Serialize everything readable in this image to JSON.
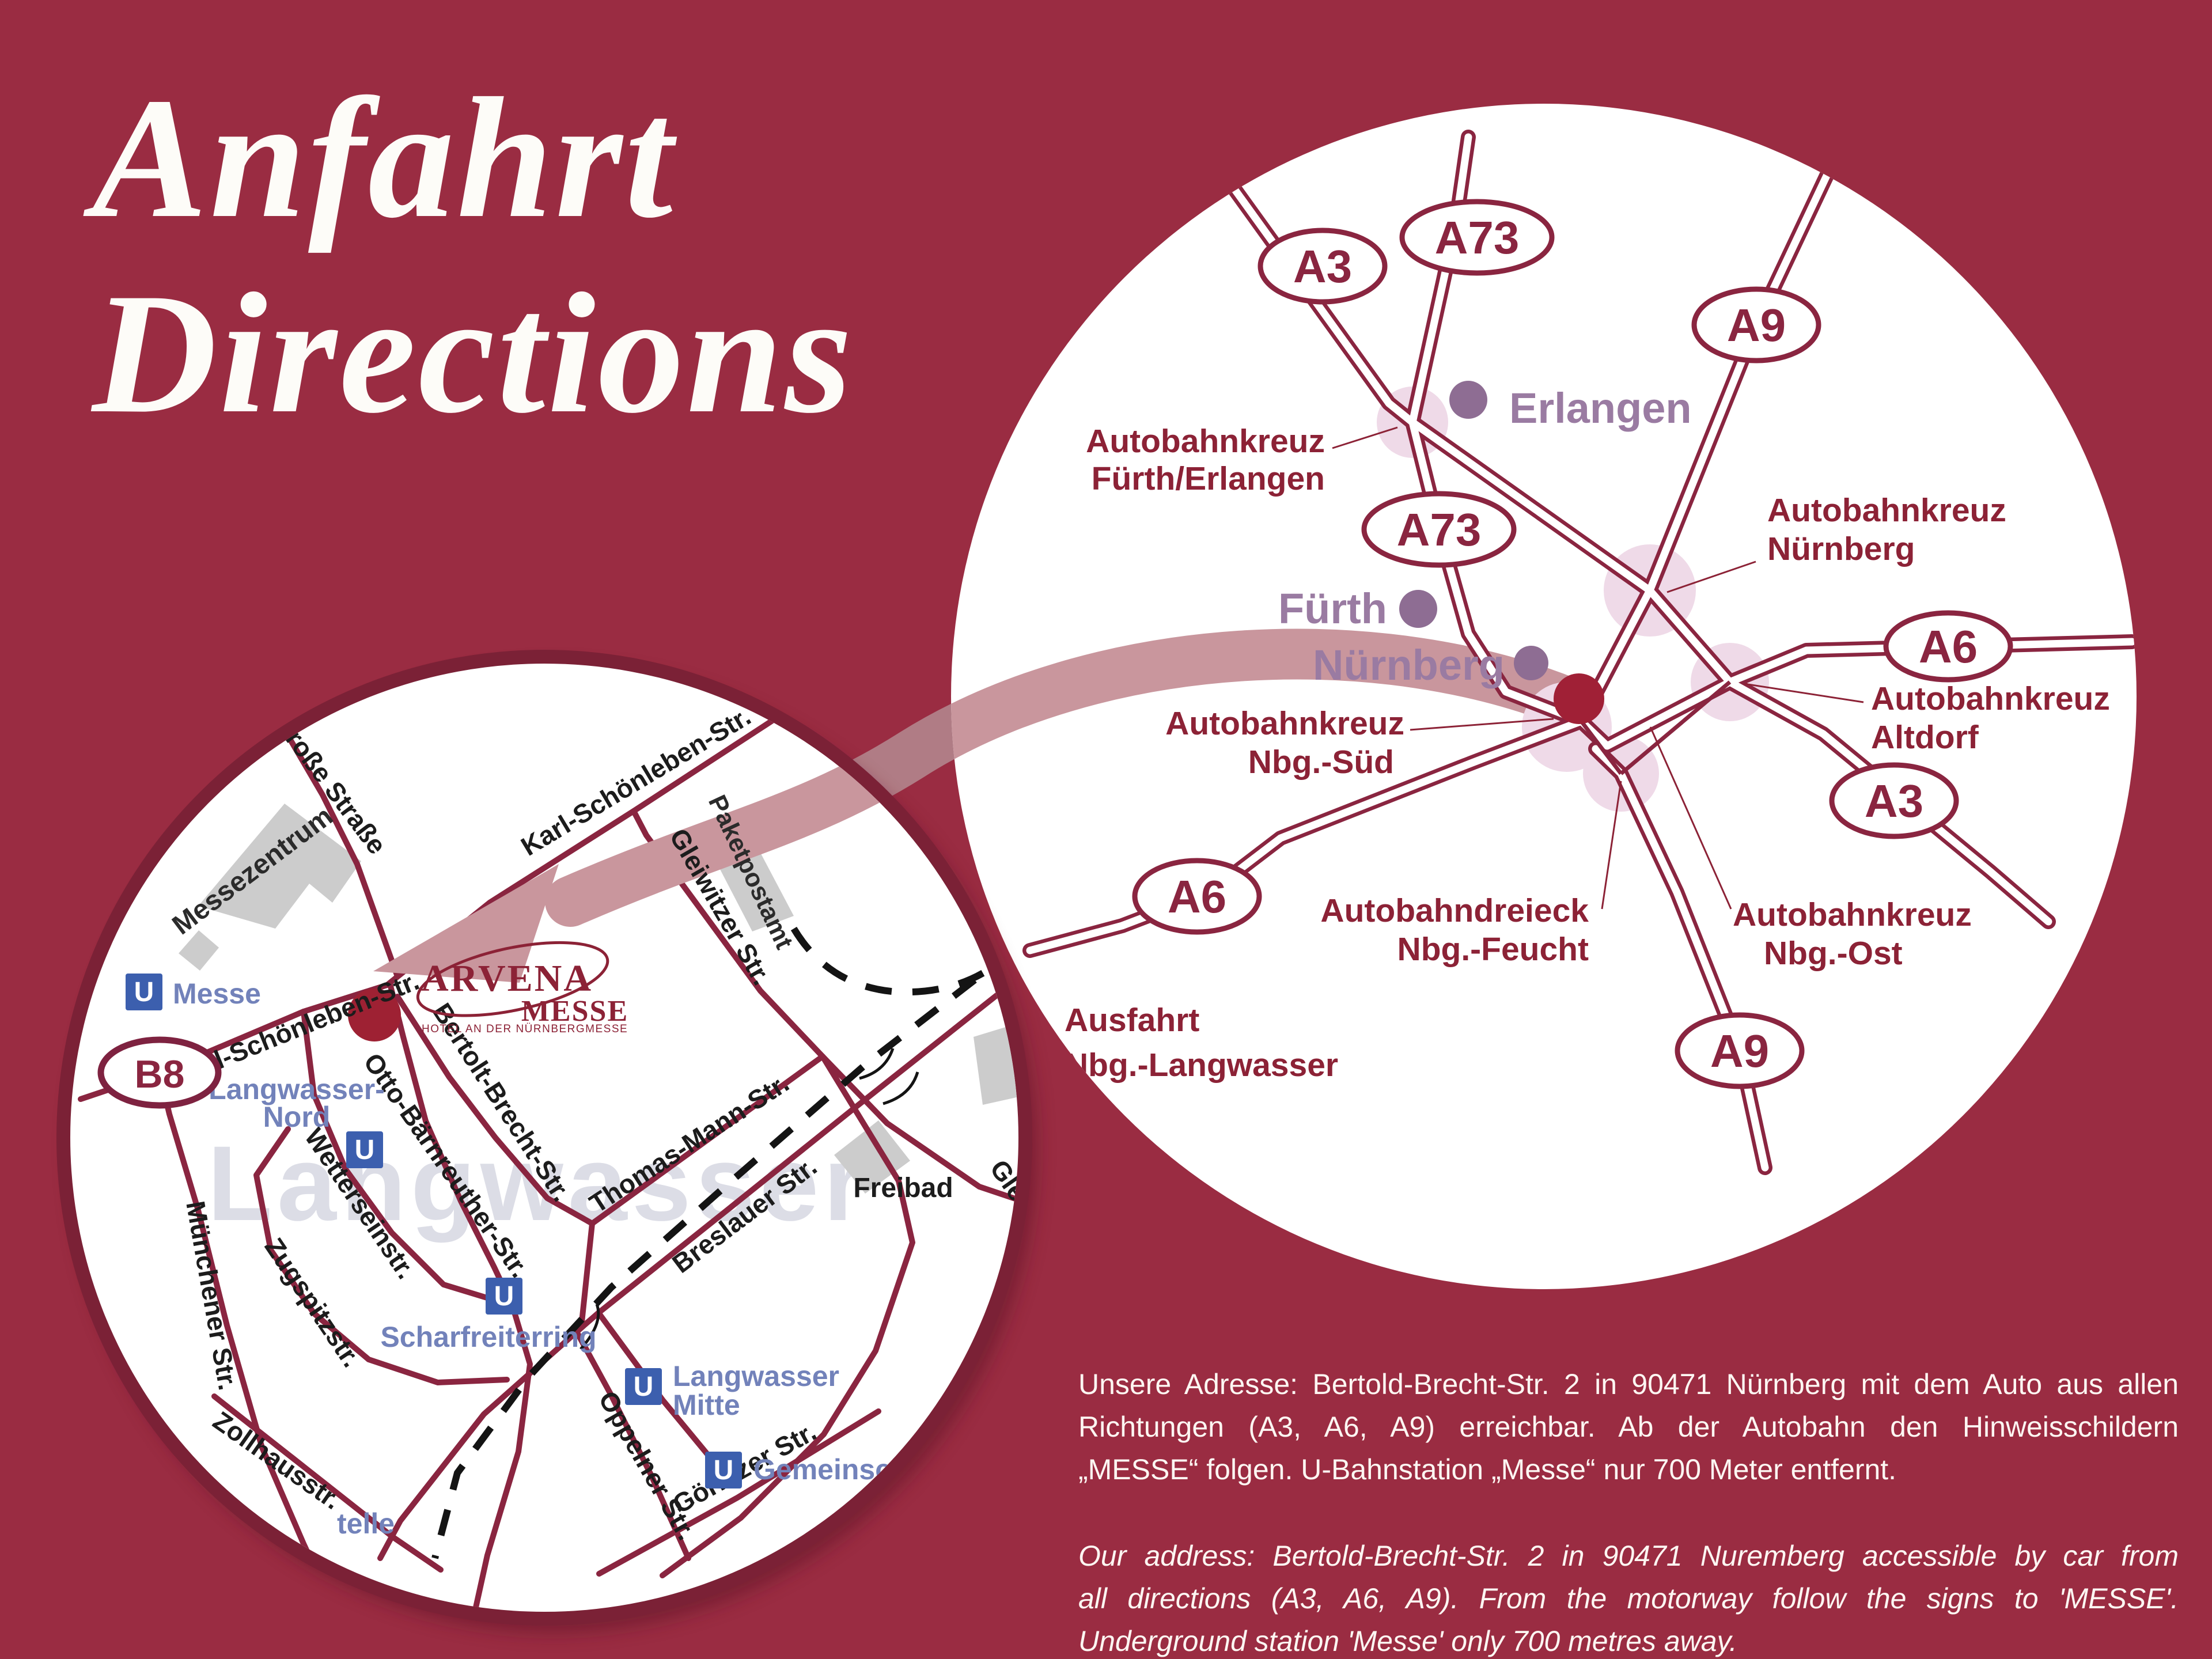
{
  "title": {
    "line1": "Anfahrt",
    "line2": "Directions"
  },
  "overview_map": {
    "badges": [
      {
        "id": "a3-north",
        "label": "A3"
      },
      {
        "id": "a73-north",
        "label": "A73"
      },
      {
        "id": "a9-north",
        "label": "A9"
      },
      {
        "id": "a73-mid",
        "label": "A73"
      },
      {
        "id": "a6-east",
        "label": "A6"
      },
      {
        "id": "a3-southeast",
        "label": "A3"
      },
      {
        "id": "a6-west",
        "label": "A6"
      },
      {
        "id": "a9-south",
        "label": "A9"
      }
    ],
    "cities": [
      {
        "name": "Erlangen"
      },
      {
        "name": "Fürth"
      },
      {
        "name": "Nürnberg"
      }
    ],
    "junctions": [
      {
        "line1": "Autobahnkreuz",
        "line2": "Fürth/Erlangen"
      },
      {
        "line1": "Autobahnkreuz",
        "line2": "Nürnberg"
      },
      {
        "line1": "Autobahnkreuz",
        "line2": "Altdorf"
      },
      {
        "line1": "Autobahnkreuz",
        "line2": "Nbg.-Süd"
      },
      {
        "line1": "Autobahndreieck",
        "line2": "Nbg.-Feucht"
      },
      {
        "line1": "Autobahnkreuz",
        "line2": "Nbg.-Ost"
      },
      {
        "line1": "Ausfahrt",
        "line2": "Nbg.-Langwasser"
      }
    ]
  },
  "detail_map": {
    "streets": {
      "grosse": "Große Straße",
      "ks": "Karl-Schönleben-Str.",
      "otto": "Otto-Bärnreuther-Str.",
      "bertolt": "Bertolt-Brecht-Str.",
      "thomas": "Thomas-Mann-Str.",
      "gleiwitzer": "Gleiwitzer Str.",
      "gleiw_partial": "Gleiw",
      "breslauer": "Breslauer Str.",
      "oppelner": "Oppelner Str.",
      "goerlitzer": "Görlitzer Str.",
      "muenchener": "Münchener Str.",
      "zollhaus": "Zollhausstr.",
      "wetterstein": "Wetterseinstr.",
      "zugspitz": "Zugspitzstr."
    },
    "places": {
      "messezentrum": "Messezentrum",
      "paketpostamt": "Paketpostamt",
      "freibad": "Freibad",
      "district": "Langwasser"
    },
    "stations": {
      "u": "U",
      "messe": "Messe",
      "lw_nord1": "Langwasser-",
      "lw_nord2": "Nord",
      "scharfreiterring": "Scharfreiterring",
      "lw_mitte1": "Langwasser",
      "lw_mitte2": "Mitte",
      "gemeinsch": "Gemeinsch",
      "telle_partial": "telle"
    },
    "b8": "B8",
    "logo": {
      "name": "ARVENA",
      "sub": "MESSE",
      "tagline": "HOTEL AN DER NÜRNBERGMESSE"
    }
  },
  "address": {
    "de": [
      "Unsere Adresse: Bertold-Brecht-Str. 2 in 90471 Nürnberg mit dem Auto aus allen",
      "Richtungen (A3, A6, A9) erreichbar. Ab der Autobahn den Hinweisschildern",
      "„MESSE“ folgen. U-Bahnstation „Messe“ nur 700 Meter entfernt."
    ],
    "en": [
      "Our address: Bertold-Brecht-Str. 2 in 90471 Nuremberg accessible by car from",
      "all directions (A3, A6, A9). From the motorway follow the signs to 'MESSE'.",
      "Underground station 'Messe' only 700 metres away."
    ]
  },
  "colors": {
    "background": "#9a2c42",
    "road": "#8a2540",
    "label_maroon": "#8c2236",
    "city_dot": "#8e6d93",
    "route_band": "#c9969d",
    "ubahn_blue": "#3c5fae",
    "station_text": "#7282ba",
    "hotel_dot": "#9e2133"
  }
}
